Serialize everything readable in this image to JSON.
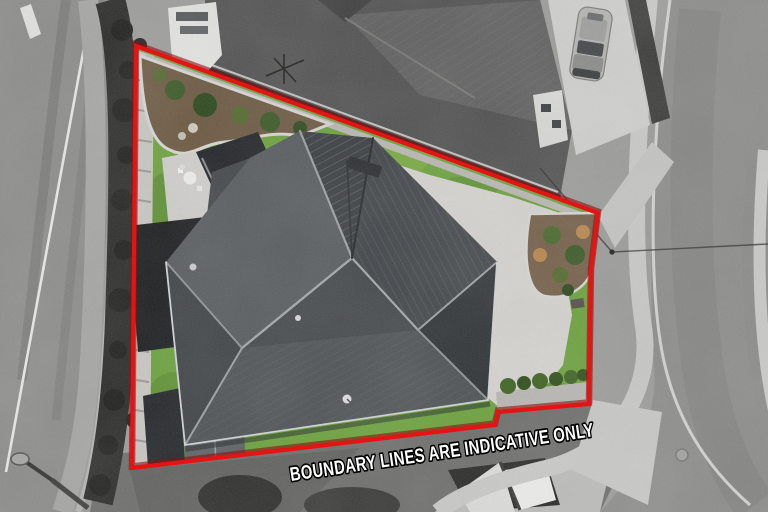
{
  "scene": {
    "description": "Top-down aerial photograph of a residential lot. The lot interior is in colour; everything outside the red boundary is desaturated grayscale.",
    "subject": "single-storey house with dark charcoal hip roof"
  },
  "overlay": {
    "disclaimer": "BOUNDARY LINES ARE INDICATIVE ONLY",
    "text_color": "#ffffff",
    "outline_color": "#000000"
  },
  "boundary": {
    "color": "#e41414",
    "underlay_color": "#8d1010",
    "stroke_width": "4.2",
    "points": "136,46 598,213 591,270 589,404 498,412 495,425 132,468"
  },
  "palette": {
    "grass": "#6ca23d",
    "grass_light": "#8ab44c",
    "grass_dark": "#4f7c2b",
    "roof_base": "#44484b",
    "roof_light": "#585c5f",
    "roof_dark": "#303437",
    "ridge": "#a4a8ab",
    "concrete": "#d5d3cf",
    "mulch": "#6d5a43",
    "road_gray": "#8d8d8b",
    "verge_gray": "#9c9c9a",
    "hedge_dark": "#26261f",
    "path_light": "#c9c9c7",
    "neighbor_roof": "#525252",
    "white_wall": "#e3e3e1"
  }
}
